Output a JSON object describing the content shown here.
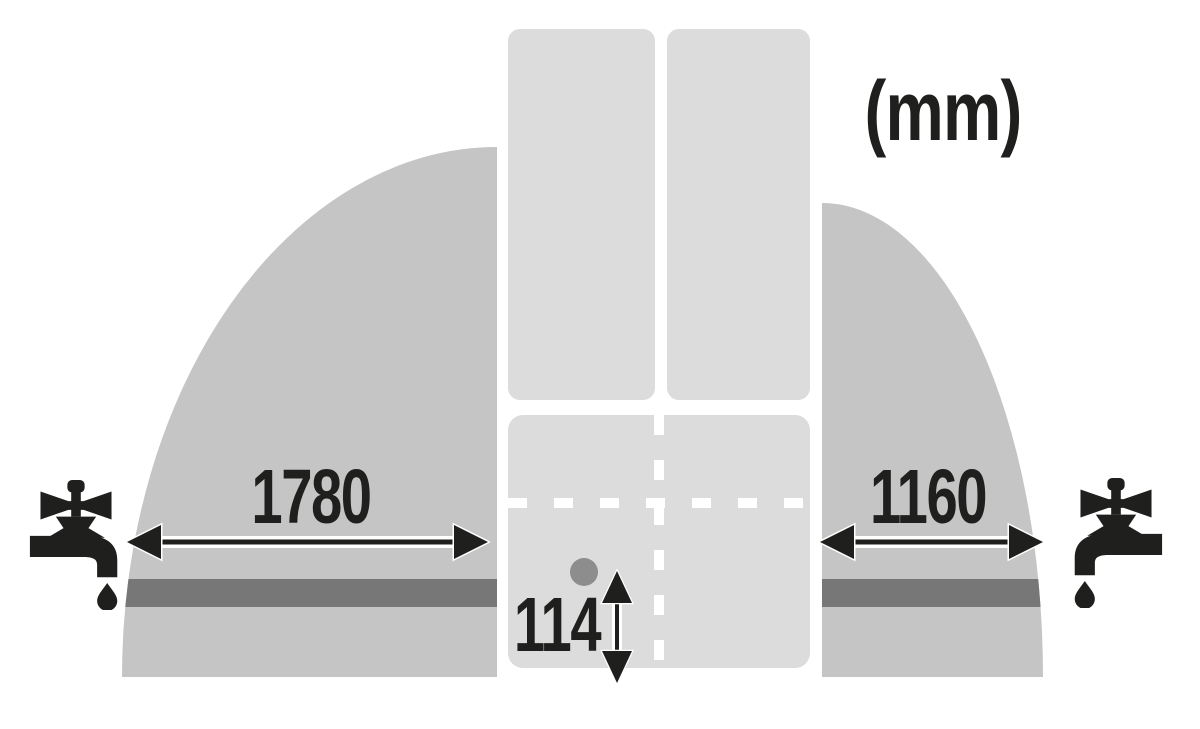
{
  "unit_label": "(mm)",
  "measurements": {
    "left_reach_mm": "1780",
    "right_reach_mm": "1160",
    "inlet_offset_mm": "114"
  },
  "icons": {
    "left_tap": "faucet-icon",
    "right_tap": "faucet-icon",
    "left_reach_arrow": "double-headed-horizontal-arrow",
    "right_reach_arrow": "double-headed-horizontal-arrow",
    "inlet_offset_arrow": "double-headed-vertical-arrow",
    "inlet_marker": "dot-marker"
  },
  "colors": {
    "background": "#ffffff",
    "reach_area_gray": "#c5c5c5",
    "appliance_gray": "#dcdcdc",
    "hose_bar_gray": "#777777",
    "dot_gray": "#8d8d8d",
    "ink_black": "#1f1f1e"
  }
}
